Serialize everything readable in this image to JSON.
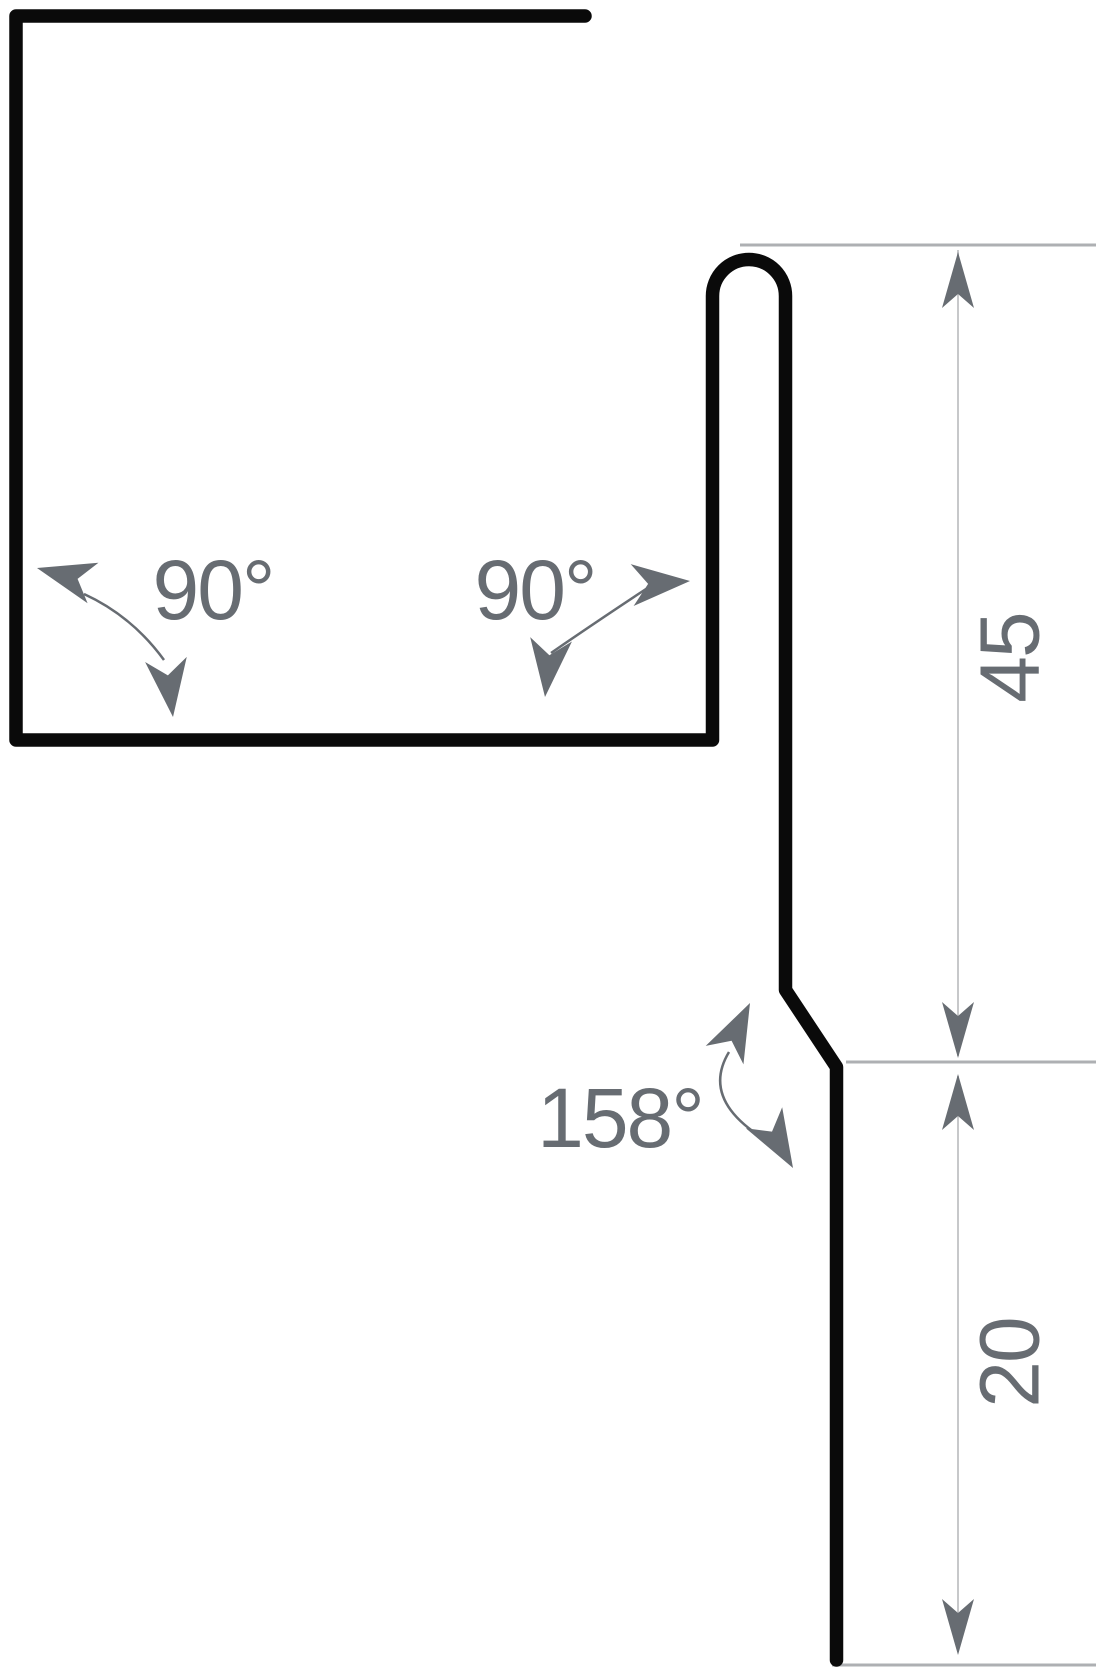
{
  "title": "Sheet metal flashing profile cross-section",
  "colors": {
    "background": "#ffffff",
    "profile_line": "#0a0a0a",
    "annotation": "#676c72",
    "extension_line": "#aeb0b3",
    "dimension_line": "#c7c8ca"
  },
  "annotations": {
    "angles": [
      {
        "id": "left-corner",
        "label": "90°"
      },
      {
        "id": "right-corner",
        "label": "90°"
      },
      {
        "id": "kick-bend",
        "label": "158°"
      }
    ],
    "dimensions": [
      {
        "id": "upper-face-height",
        "label": "45"
      },
      {
        "id": "lower-drip-height",
        "label": "20"
      }
    ]
  }
}
